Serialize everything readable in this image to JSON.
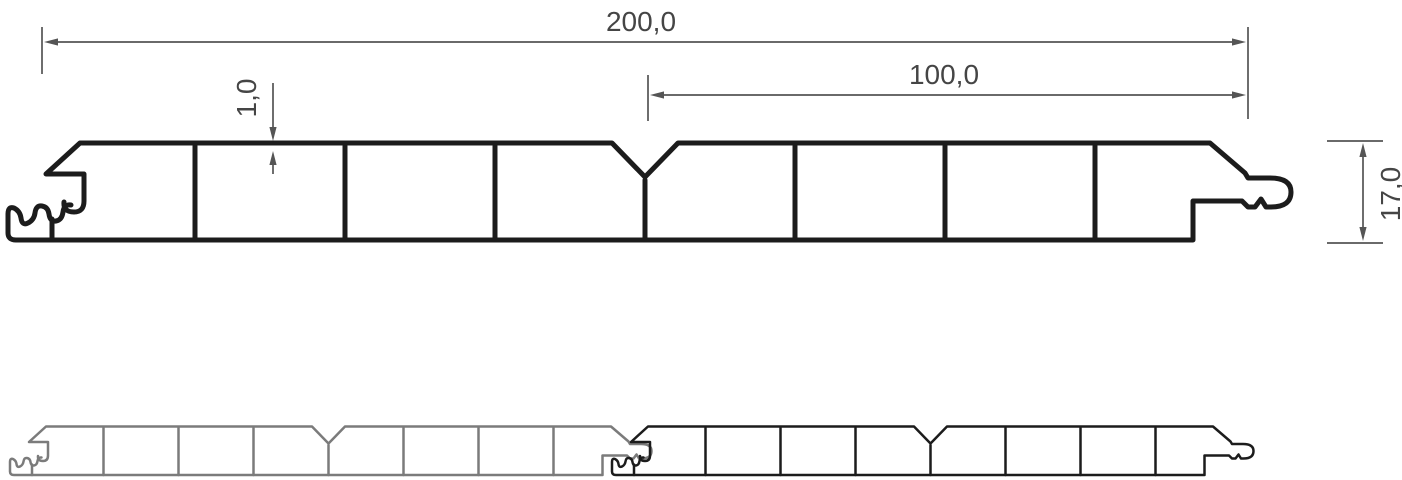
{
  "drawing": {
    "dimensions": {
      "width_total": {
        "label": "200,0"
      },
      "width_half": {
        "label": "100,0"
      },
      "wall_thickness": {
        "label": "1,0"
      },
      "height": {
        "label": "17,0"
      }
    },
    "colors": {
      "profile": "#1c1c1c",
      "panel_left": "#7b7b7b",
      "panel_right": "#1c1c1c",
      "dimension": "#555555",
      "text": "#454545",
      "background": "#ffffff"
    }
  }
}
